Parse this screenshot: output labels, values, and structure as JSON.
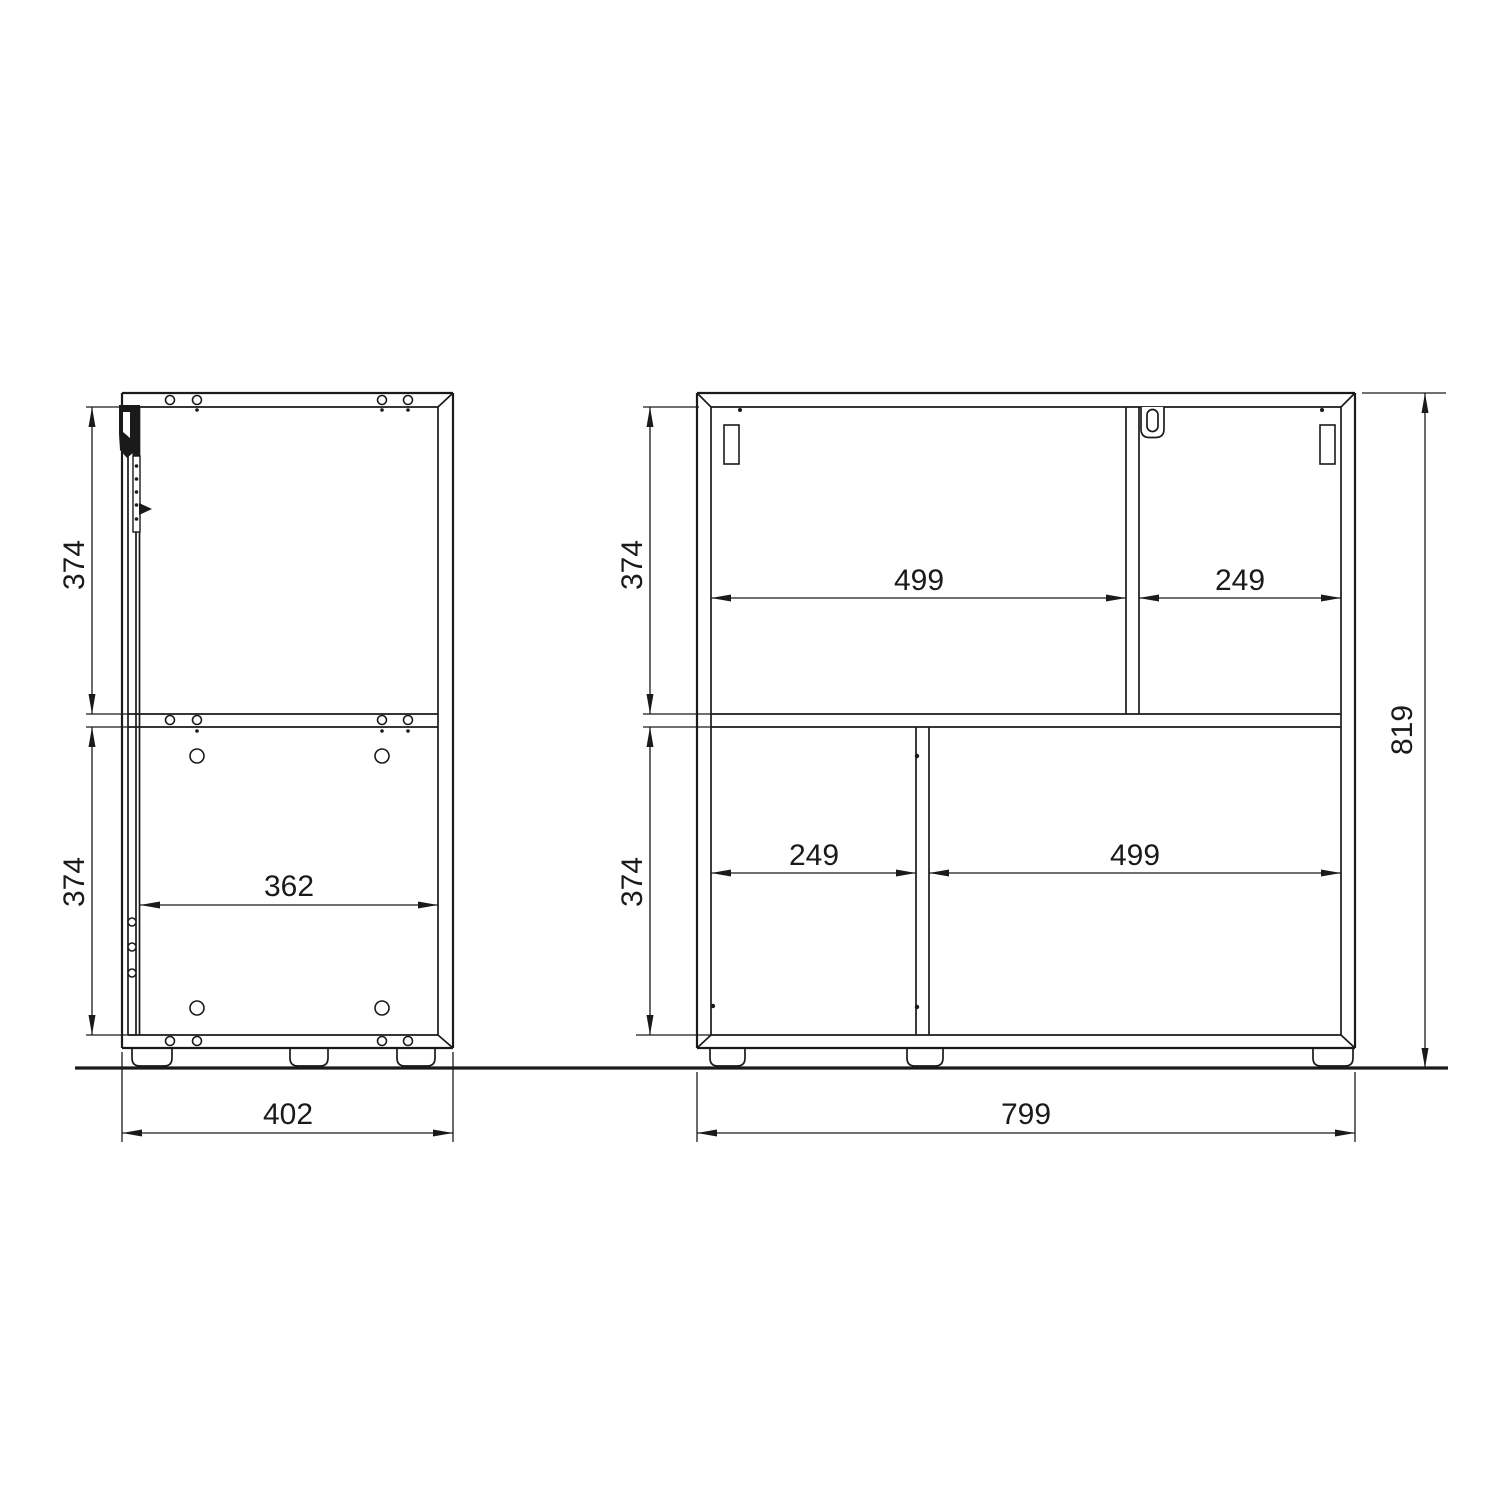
{
  "drawing": {
    "type": "furniture-dimension-drawing",
    "background_color": "#ffffff",
    "line_color": "#1a1a1a"
  },
  "dims": {
    "side": {
      "upper_height": "374",
      "lower_height": "374",
      "interior_depth": "362",
      "overall_depth": "402"
    },
    "front": {
      "upper_height": "374",
      "lower_height": "374",
      "top_left": "499",
      "top_right": "249",
      "bottom_left": "249",
      "bottom_right": "499",
      "overall_width": "799",
      "overall_height": "819"
    }
  }
}
